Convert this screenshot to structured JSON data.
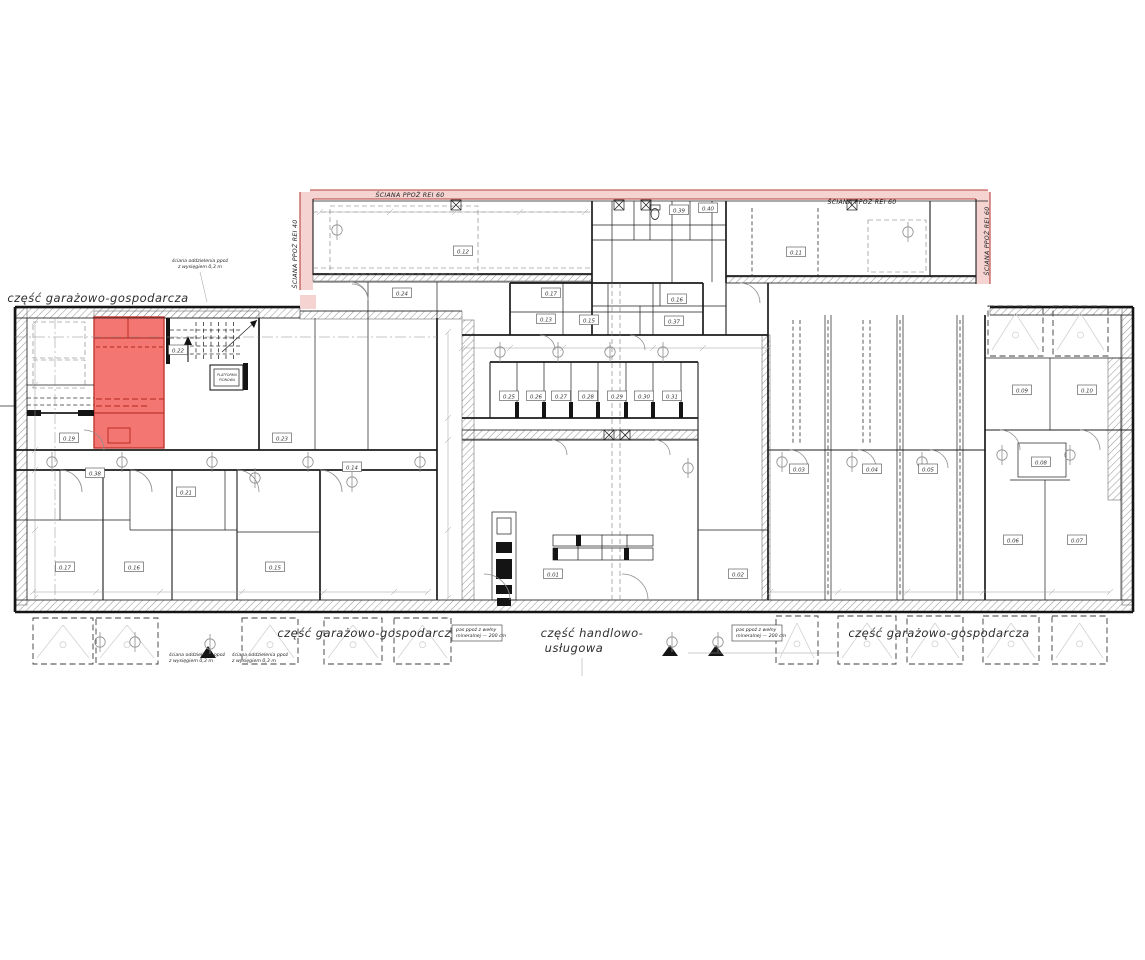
{
  "plan": {
    "colors": {
      "highlight_fill": "#f2635f",
      "highlight_line": "#c23730",
      "firewall_fill": "#f4d3d1",
      "firewall_line": "#b8423c",
      "ink": "#1c1c1c"
    },
    "zones": [
      {
        "key": "zone-garage-top-left",
        "text": "część garażowo-gospodarcza",
        "x": 98,
        "y": 302,
        "anchor": "middle"
      },
      {
        "key": "zone-garage-bottom-left",
        "text": "część garażowo-gospodarcza",
        "x": 368,
        "y": 637,
        "anchor": "middle"
      },
      {
        "key": "zone-retail-line1",
        "text": "część handlowo-",
        "x": 592,
        "y": 637,
        "anchor": "middle"
      },
      {
        "key": "zone-retail-line2",
        "text": "usługowa",
        "x": 574,
        "y": 652,
        "anchor": "middle"
      },
      {
        "key": "zone-garage-bottom-right",
        "text": "część garażowo-gospodarcza",
        "x": 939,
        "y": 637,
        "anchor": "middle"
      }
    ],
    "firewall_labels": [
      {
        "key": "firewall-top-left",
        "text": "ŚCIANA PPOŻ REI 60",
        "x": 410,
        "y": 197,
        "rotate": 0
      },
      {
        "key": "firewall-top-right",
        "text": "ŚCIANA PPOŻ REI 60",
        "x": 862,
        "y": 204,
        "rotate": 0
      },
      {
        "key": "firewall-left-vertical",
        "text": "ŚCIANA PPOŻ REI 40",
        "x": 297,
        "y": 254,
        "rotate": -90
      },
      {
        "key": "firewall-right-vertical",
        "text": "ŚCIANA PPOŻ REI 60",
        "x": 989,
        "y": 241,
        "rotate": -90
      }
    ],
    "annotations": [
      {
        "key": "note-separation-wall-top",
        "lines": [
          "ściana oddzielenia ppoż",
          "z wysięgiem 0,3 m"
        ],
        "x": 200,
        "y": 262,
        "anchor": "middle",
        "boxed": false
      },
      {
        "key": "note-separation-wall-bottom-1",
        "lines": [
          "ściana oddzielenia ppoż",
          "z wysięgiem 0,3 m"
        ],
        "x": 169,
        "y": 656,
        "anchor": "start",
        "boxed": false
      },
      {
        "key": "note-separation-wall-bottom-2",
        "lines": [
          "ściana oddzielenia ppoż",
          "z wysięgiem 0,3 m"
        ],
        "x": 232,
        "y": 656,
        "anchor": "start",
        "boxed": false
      },
      {
        "key": "note-mineral-wool-left",
        "lines": [
          "pas ppoż z wełny",
          "mineralnej — 200 cm"
        ],
        "x": 456,
        "y": 631,
        "anchor": "start",
        "boxed": true
      },
      {
        "key": "note-mineral-wool-right",
        "lines": [
          "pas ppoż z wełny",
          "mineralnej — 200 cm"
        ],
        "x": 736,
        "y": 631,
        "anchor": "start",
        "boxed": true
      }
    ],
    "micro_labels": [
      {
        "key": "platform-label-1",
        "text": "PLATFORMA",
        "x": 227,
        "y": 376
      },
      {
        "key": "platform-label-2",
        "text": "PIONOWA",
        "x": 227,
        "y": 381
      }
    ],
    "rooms": [
      {
        "id": "0.01",
        "x": 553,
        "y": 574
      },
      {
        "id": "0.02",
        "x": 738,
        "y": 574
      },
      {
        "id": "0.03",
        "x": 799,
        "y": 469
      },
      {
        "id": "0.04",
        "x": 872,
        "y": 469
      },
      {
        "id": "0.05",
        "x": 928,
        "y": 469
      },
      {
        "id": "0.06",
        "x": 1013,
        "y": 540
      },
      {
        "id": "0.07",
        "x": 1077,
        "y": 540
      },
      {
        "id": "0.08",
        "x": 1041,
        "y": 462
      },
      {
        "id": "0.09",
        "x": 1022,
        "y": 390
      },
      {
        "id": "0.10",
        "x": 1087,
        "y": 390
      },
      {
        "id": "0.11",
        "x": 796,
        "y": 252
      },
      {
        "id": "0.12",
        "x": 463,
        "y": 251
      },
      {
        "id": "0.13",
        "x": 546,
        "y": 319
      },
      {
        "id": "0.14",
        "x": 352,
        "y": 467
      },
      {
        "id": "0.15",
        "x": 589,
        "y": 320
      },
      {
        "id": "0.16",
        "x": 677,
        "y": 299
      },
      {
        "id": "0.17",
        "x": 551,
        "y": 293
      },
      {
        "id": "0.19",
        "x": 69,
        "y": 438
      },
      {
        "id": "0.21",
        "x": 186,
        "y": 492
      },
      {
        "id": "0.22",
        "x": 178,
        "y": 350
      },
      {
        "id": "0.23",
        "x": 282,
        "y": 438
      },
      {
        "id": "0.24",
        "x": 402,
        "y": 293
      },
      {
        "id": "0.25",
        "x": 509,
        "y": 396
      },
      {
        "id": "0.26",
        "x": 536,
        "y": 396
      },
      {
        "id": "0.27",
        "x": 561,
        "y": 396
      },
      {
        "id": "0.28",
        "x": 588,
        "y": 396
      },
      {
        "id": "0.29",
        "x": 617,
        "y": 396
      },
      {
        "id": "0.30",
        "x": 644,
        "y": 396
      },
      {
        "id": "0.31",
        "x": 672,
        "y": 396
      },
      {
        "id": "0.37",
        "x": 674,
        "y": 321
      },
      {
        "id": "0.38",
        "x": 95,
        "y": 473
      },
      {
        "id": "0.39",
        "x": 679,
        "y": 210
      },
      {
        "id": "0.40",
        "x": 708,
        "y": 208
      },
      {
        "id": "0.17",
        "x": 65,
        "y": 567
      },
      {
        "id": "0.16",
        "x": 134,
        "y": 567
      },
      {
        "id": "0.15",
        "x": 275,
        "y": 567
      }
    ]
  }
}
